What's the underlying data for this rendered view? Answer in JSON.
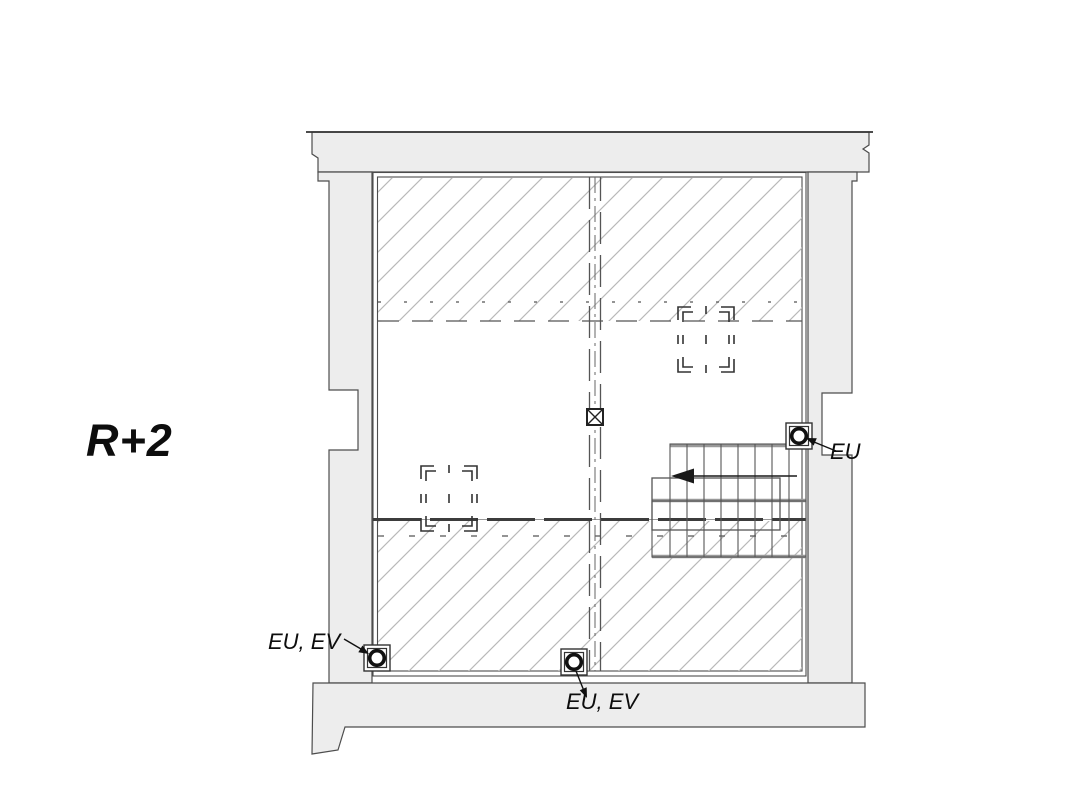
{
  "floor_label": "R+2",
  "drains": [
    {
      "label": "EU",
      "position": "right-wall"
    },
    {
      "label": "EU, EV",
      "position": "bottom-left"
    },
    {
      "label": "EU, EV",
      "position": "bottom-center"
    }
  ],
  "colors": {
    "wall_fill": "#ededed",
    "wall_outline": "#4d4d4d",
    "hatch_line": "#b9b9b9",
    "ink": "#111111",
    "stair_edge_gray": "#999999"
  },
  "symbols": [
    "floor-drain-symbol",
    "skylight-symbol",
    "staircase",
    "duct-axis-symbol",
    "direction-arrow"
  ]
}
